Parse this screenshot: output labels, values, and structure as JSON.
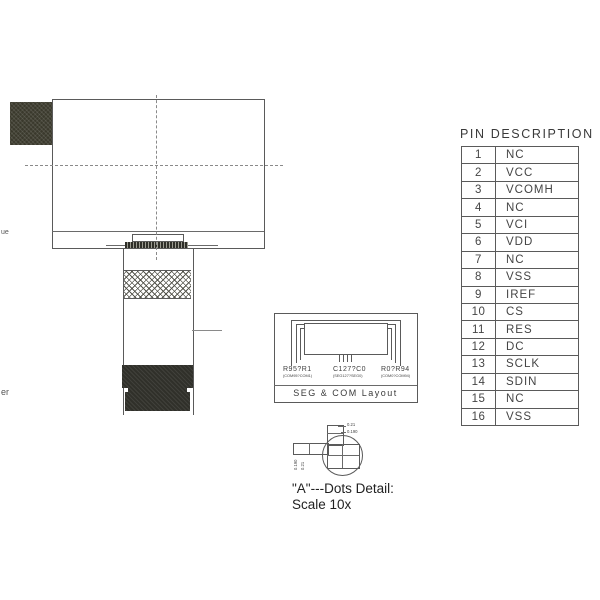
{
  "fragments": {
    "left_top": "ue",
    "left_bottom": "er"
  },
  "seg_com": {
    "caption": "SEG & COM Layout",
    "label_left": "R95?R1",
    "label_left_sub": "(COM95?COM1)",
    "label_center": "C127?C0",
    "label_center_sub": "(SEG127?SEG0)",
    "label_right": "R0?R94",
    "label_right_sub": "(COM0?COM94)"
  },
  "dots_detail": {
    "dim_top1": "0.21",
    "dim_top2": "0.190",
    "dim_left1": "0.190",
    "dim_left2": "0.21",
    "caption_line1": "\"A\"---Dots Detail:",
    "caption_line2": "Scale 10x"
  },
  "pin_table": {
    "title": "PIN DESCRIPTION",
    "rows": [
      [
        "1",
        "NC"
      ],
      [
        "2",
        "VCC"
      ],
      [
        "3",
        "VCOMH"
      ],
      [
        "4",
        "NC"
      ],
      [
        "5",
        "VCI"
      ],
      [
        "6",
        "VDD"
      ],
      [
        "7",
        "NC"
      ],
      [
        "8",
        "VSS"
      ],
      [
        "9",
        "IREF"
      ],
      [
        "10",
        "CS"
      ],
      [
        "11",
        "RES"
      ],
      [
        "12",
        "DC"
      ],
      [
        "13",
        "SCLK"
      ],
      [
        "14",
        "SDIN"
      ],
      [
        "15",
        "NC"
      ],
      [
        "16",
        "VSS"
      ]
    ]
  },
  "colors": {
    "line": "#5a5a5a",
    "dark_fill": "#30302a",
    "block_fill": "#3a392c",
    "background": "#ffffff"
  }
}
